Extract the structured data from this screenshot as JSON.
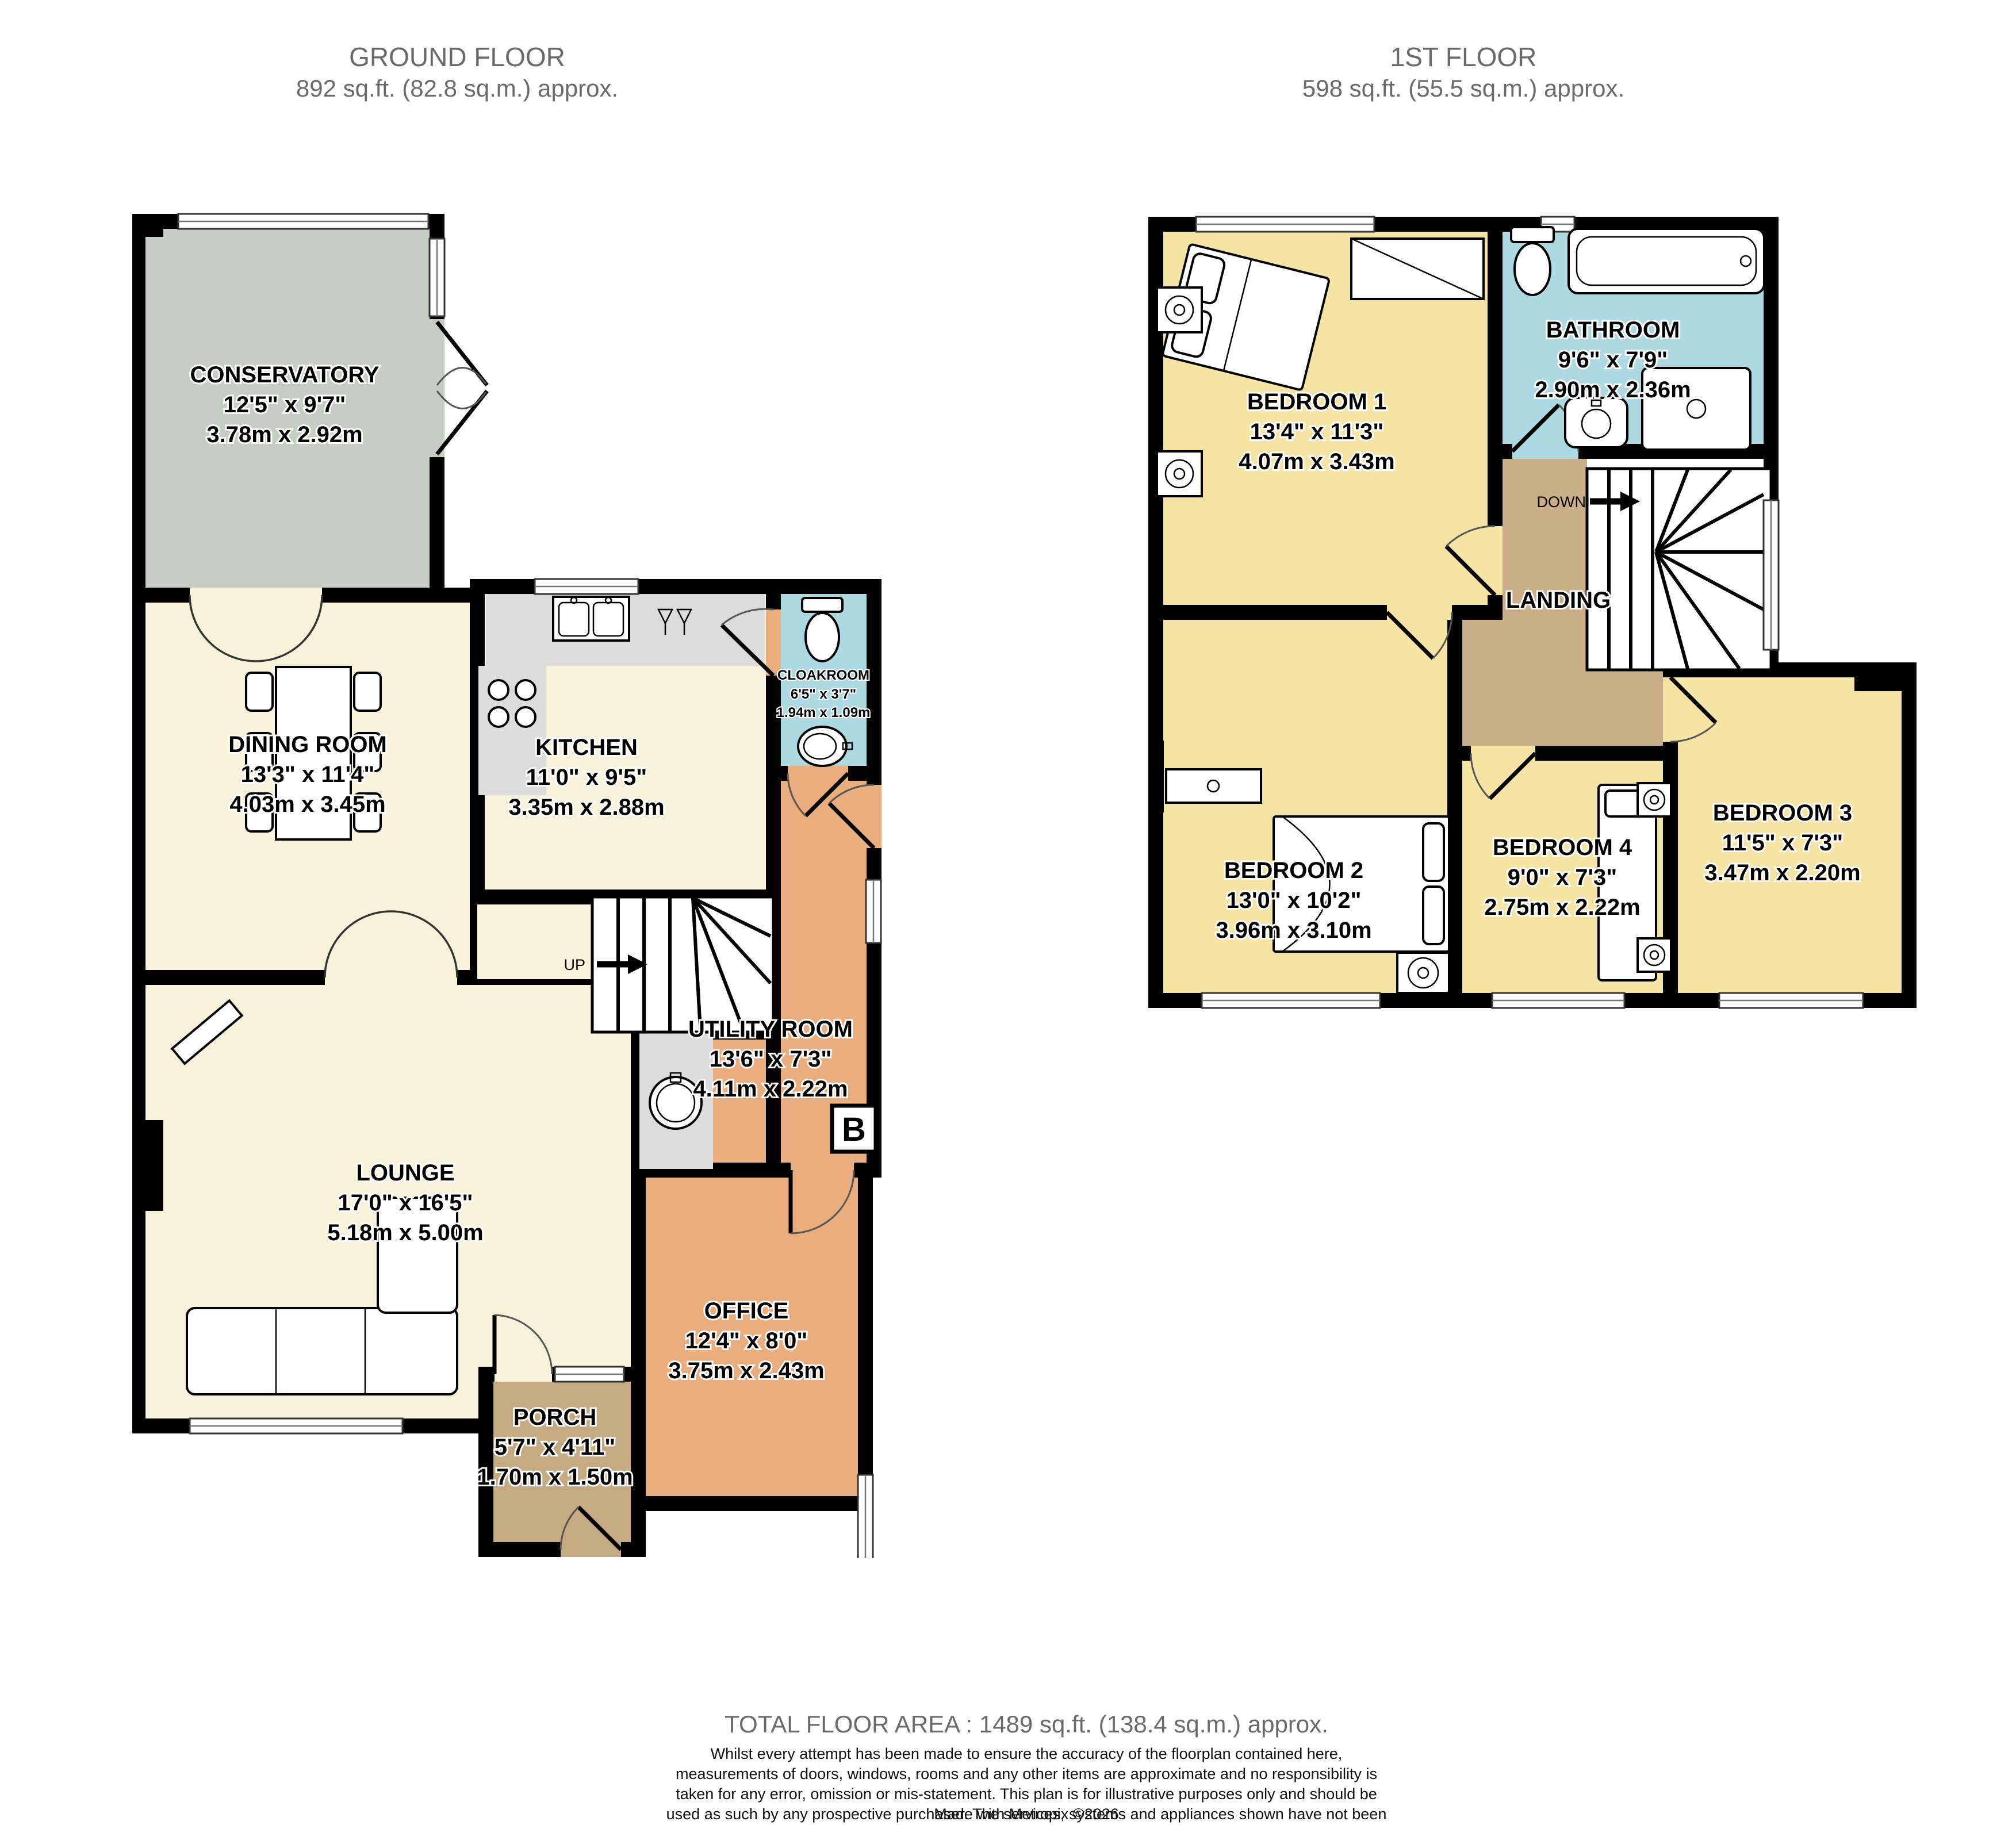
{
  "ground": {
    "title": "GROUND FLOOR",
    "area": "892 sq.ft. (82.8 sq.m.) approx.",
    "up_label": "UP",
    "boiler_label": "B",
    "rooms": {
      "conservatory": {
        "name": "CONSERVATORY",
        "imperial": "12'5\"  x 9'7\"",
        "metric": "3.78m  x 2.92m"
      },
      "dining": {
        "name": "DINING ROOM",
        "imperial": "13'3\"  x 11'4\"",
        "metric": "4.03m  x 3.45m"
      },
      "kitchen": {
        "name": "KITCHEN",
        "imperial": "11'0\"  x 9'5\"",
        "metric": "3.35m  x 2.88m"
      },
      "cloakroom": {
        "name": "CLOAKROOM",
        "imperial": "6'5\"  x 3'7\"",
        "metric": "1.94m  x 1.09m"
      },
      "lounge": {
        "name": "LOUNGE",
        "imperial": "17'0\"  x 16'5\"",
        "metric": "5.18m  x 5.00m"
      },
      "utility": {
        "name": "UTILITY ROOM",
        "imperial": "13'6\"  x 7'3\"",
        "metric": "4.11m  x 2.22m"
      },
      "office": {
        "name": "OFFICE",
        "imperial": "12'4\"  x 8'0\"",
        "metric": "3.75m  x 2.43m"
      },
      "porch": {
        "name": "PORCH",
        "imperial": "5'7\"  x 4'11\"",
        "metric": "1.70m  x 1.50m"
      }
    }
  },
  "first": {
    "title": "1ST FLOOR",
    "area": "598 sq.ft. (55.5 sq.m.) approx.",
    "down_label": "DOWN",
    "rooms": {
      "bedroom1": {
        "name": "BEDROOM 1",
        "imperial": "13'4\"  x 11'3\"",
        "metric": "4.07m  x 3.43m"
      },
      "bathroom": {
        "name": "BATHROOM",
        "imperial": "9'6\"  x 7'9\"",
        "metric": "2.90m  x 2.36m"
      },
      "landing": {
        "name": "LANDING"
      },
      "bedroom2": {
        "name": "BEDROOM 2",
        "imperial": "13'0\"  x 10'2\"",
        "metric": "3.96m  x 3.10m"
      },
      "bedroom4": {
        "name": "BEDROOM 4",
        "imperial": "9'0\"  x 7'3\"",
        "metric": "2.75m  x 2.22m"
      },
      "bedroom3": {
        "name": "BEDROOM 3",
        "imperial": "11'5\"  x 7'3\"",
        "metric": "3.47m  x 2.20m"
      }
    }
  },
  "footer": {
    "total": "TOTAL FLOOR AREA : 1489 sq.ft. (138.4 sq.m.) approx.",
    "disclaimer": "Whilst every attempt has been made to ensure the accuracy of the floorplan contained here, measurements of doors, windows, rooms and any other items are approximate and no responsibility is taken for any error, omission or mis-statement. This plan is for illustrative purposes only and should be used as such by any prospective purchaser. The services, systems and appliances shown have not been tested and no guarantee as to their operability or efficiency can be given.",
    "credit": "Made with Metropix ©2026"
  },
  "colors": {
    "cream_floor": "#f8f2da",
    "conservatory_floor": "#c6cdc2",
    "hall_floor": "#e9ad7e",
    "porch_floor": "#c6aa81",
    "landing_floor": "#c9ae87",
    "bedroom_floor": "#f5e4a3",
    "bathroom_floor": "#addae2",
    "counter_gray": "#dcdcdc",
    "wall": "#000000",
    "header_text": "#6a6a6a"
  }
}
